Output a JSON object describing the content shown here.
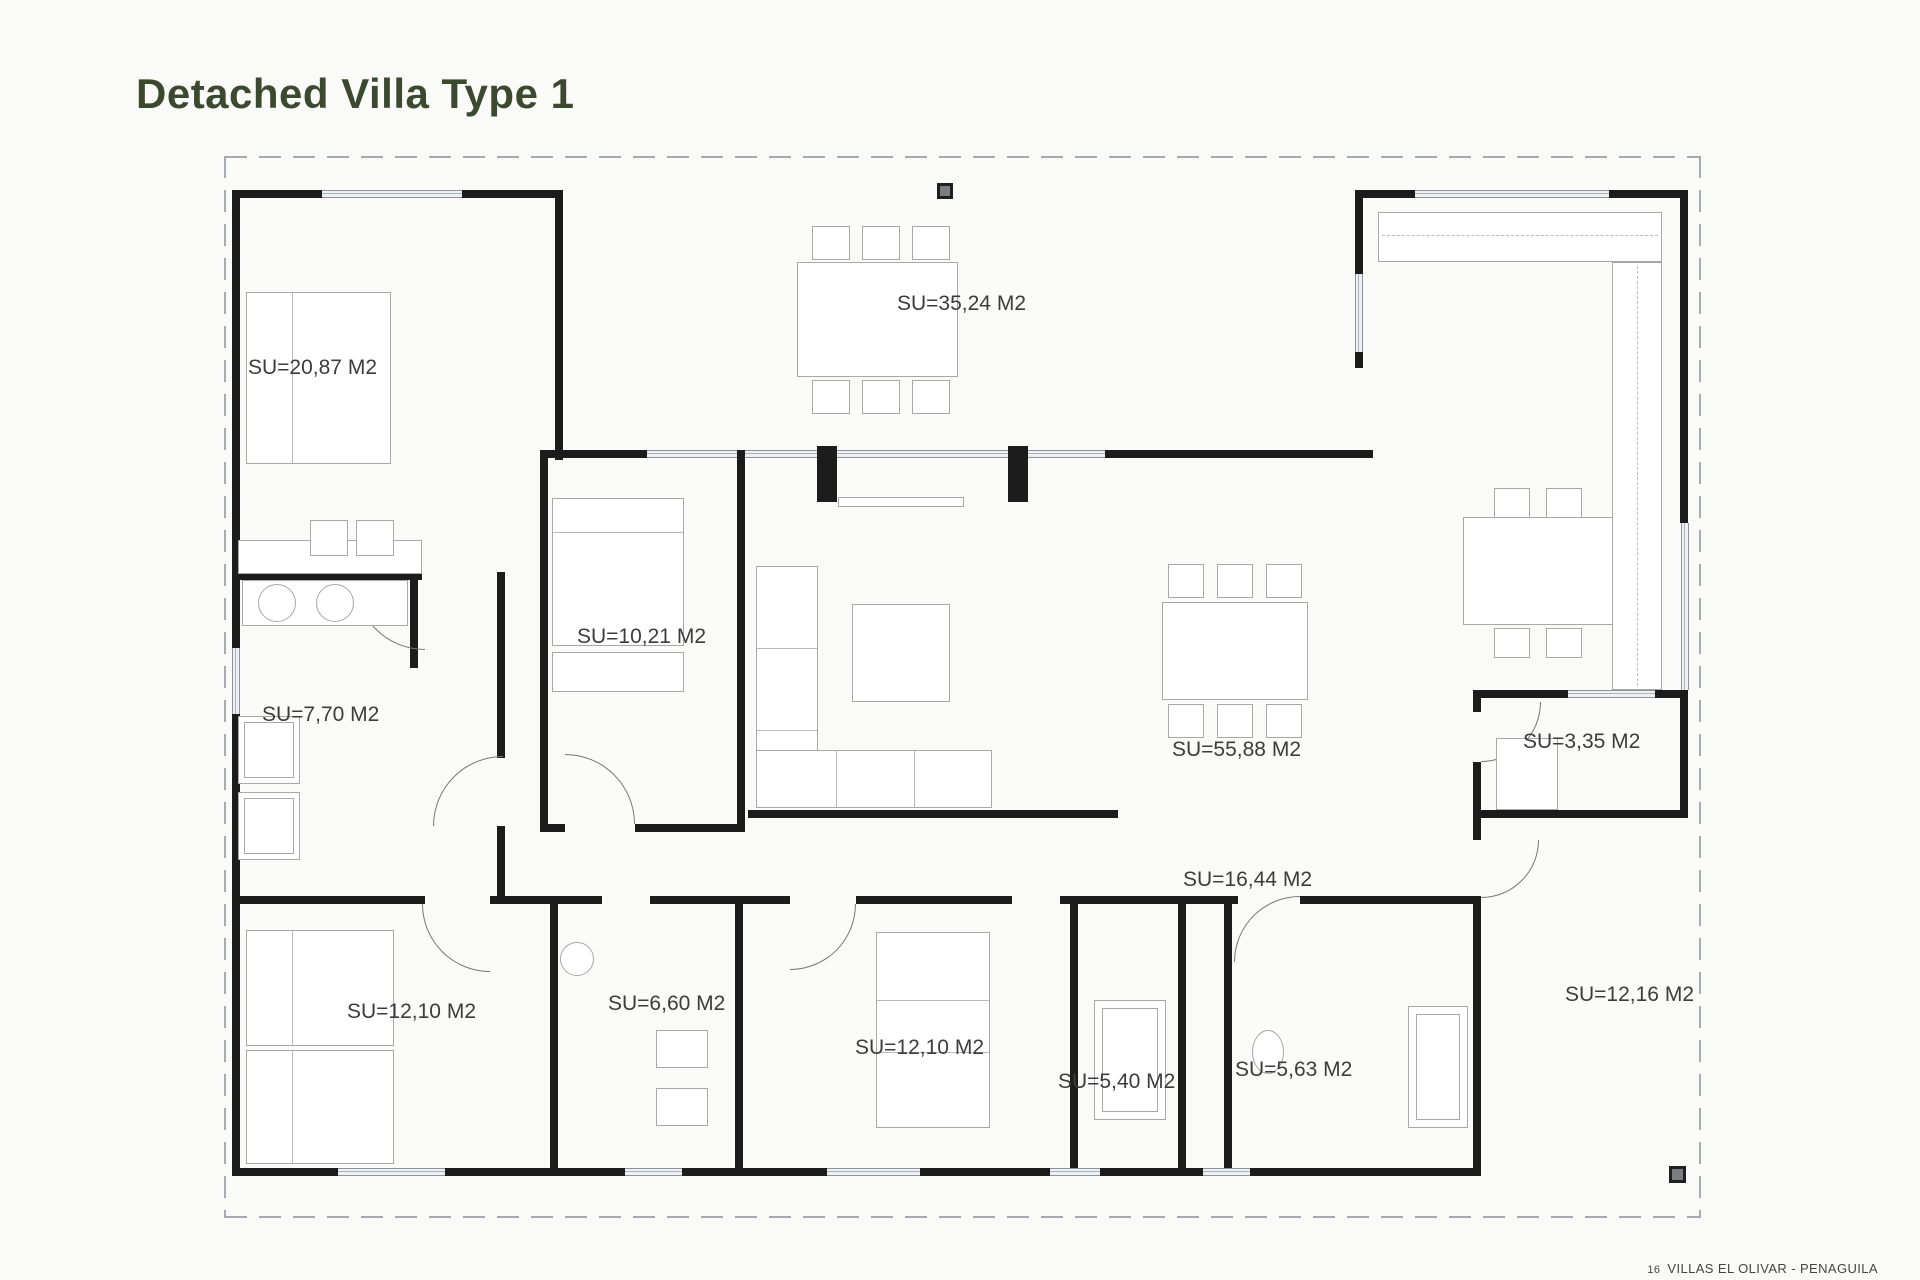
{
  "header": {
    "title": "Detached Villa Type 1"
  },
  "footer": {
    "page_number": "16",
    "text": "VILLAS EL OLIVAR - PENAGUILA"
  },
  "colors": {
    "title_green": "#3b4a2f",
    "wall_black": "#1c1c1c",
    "label_gray": "#3c3c3c",
    "boundary_dash": "#a6abb1"
  },
  "plan": {
    "rooms": [
      {
        "id": "bedroom-1",
        "label": "SU=20,87 M2",
        "x": 248,
        "y": 356
      },
      {
        "id": "porch",
        "label": "SU=35,24 M2",
        "x": 897,
        "y": 292
      },
      {
        "id": "bedroom-2",
        "label": "SU=10,21 M2",
        "x": 577,
        "y": 625
      },
      {
        "id": "bathroom-1",
        "label": "SU=7,70 M2",
        "x": 262,
        "y": 703
      },
      {
        "id": "living-room",
        "label": "SU=55,88 M2",
        "x": 1172,
        "y": 738
      },
      {
        "id": "pantry",
        "label": "SU=3,35 M2",
        "x": 1523,
        "y": 730
      },
      {
        "id": "hall",
        "label": "SU=16,44 M2",
        "x": 1183,
        "y": 868
      },
      {
        "id": "bedroom-3",
        "label": "SU=12,10 M2",
        "x": 347,
        "y": 1000
      },
      {
        "id": "bathroom-2",
        "label": "SU=6,60 M2",
        "x": 608,
        "y": 992
      },
      {
        "id": "bedroom-4",
        "label": "SU=12,10 M2",
        "x": 855,
        "y": 1036
      },
      {
        "id": "toilet",
        "label": "SU=5,40 M2",
        "x": 1058,
        "y": 1070
      },
      {
        "id": "bathroom-3",
        "label": "SU=5,63 M2",
        "x": 1235,
        "y": 1058
      },
      {
        "id": "terrace",
        "label": "SU=12,16 M2",
        "x": 1565,
        "y": 983
      }
    ],
    "pillars": [
      {
        "x": 937,
        "y": 183,
        "size": 16
      },
      {
        "x": 1669,
        "y": 1166,
        "size": 17
      }
    ]
  }
}
